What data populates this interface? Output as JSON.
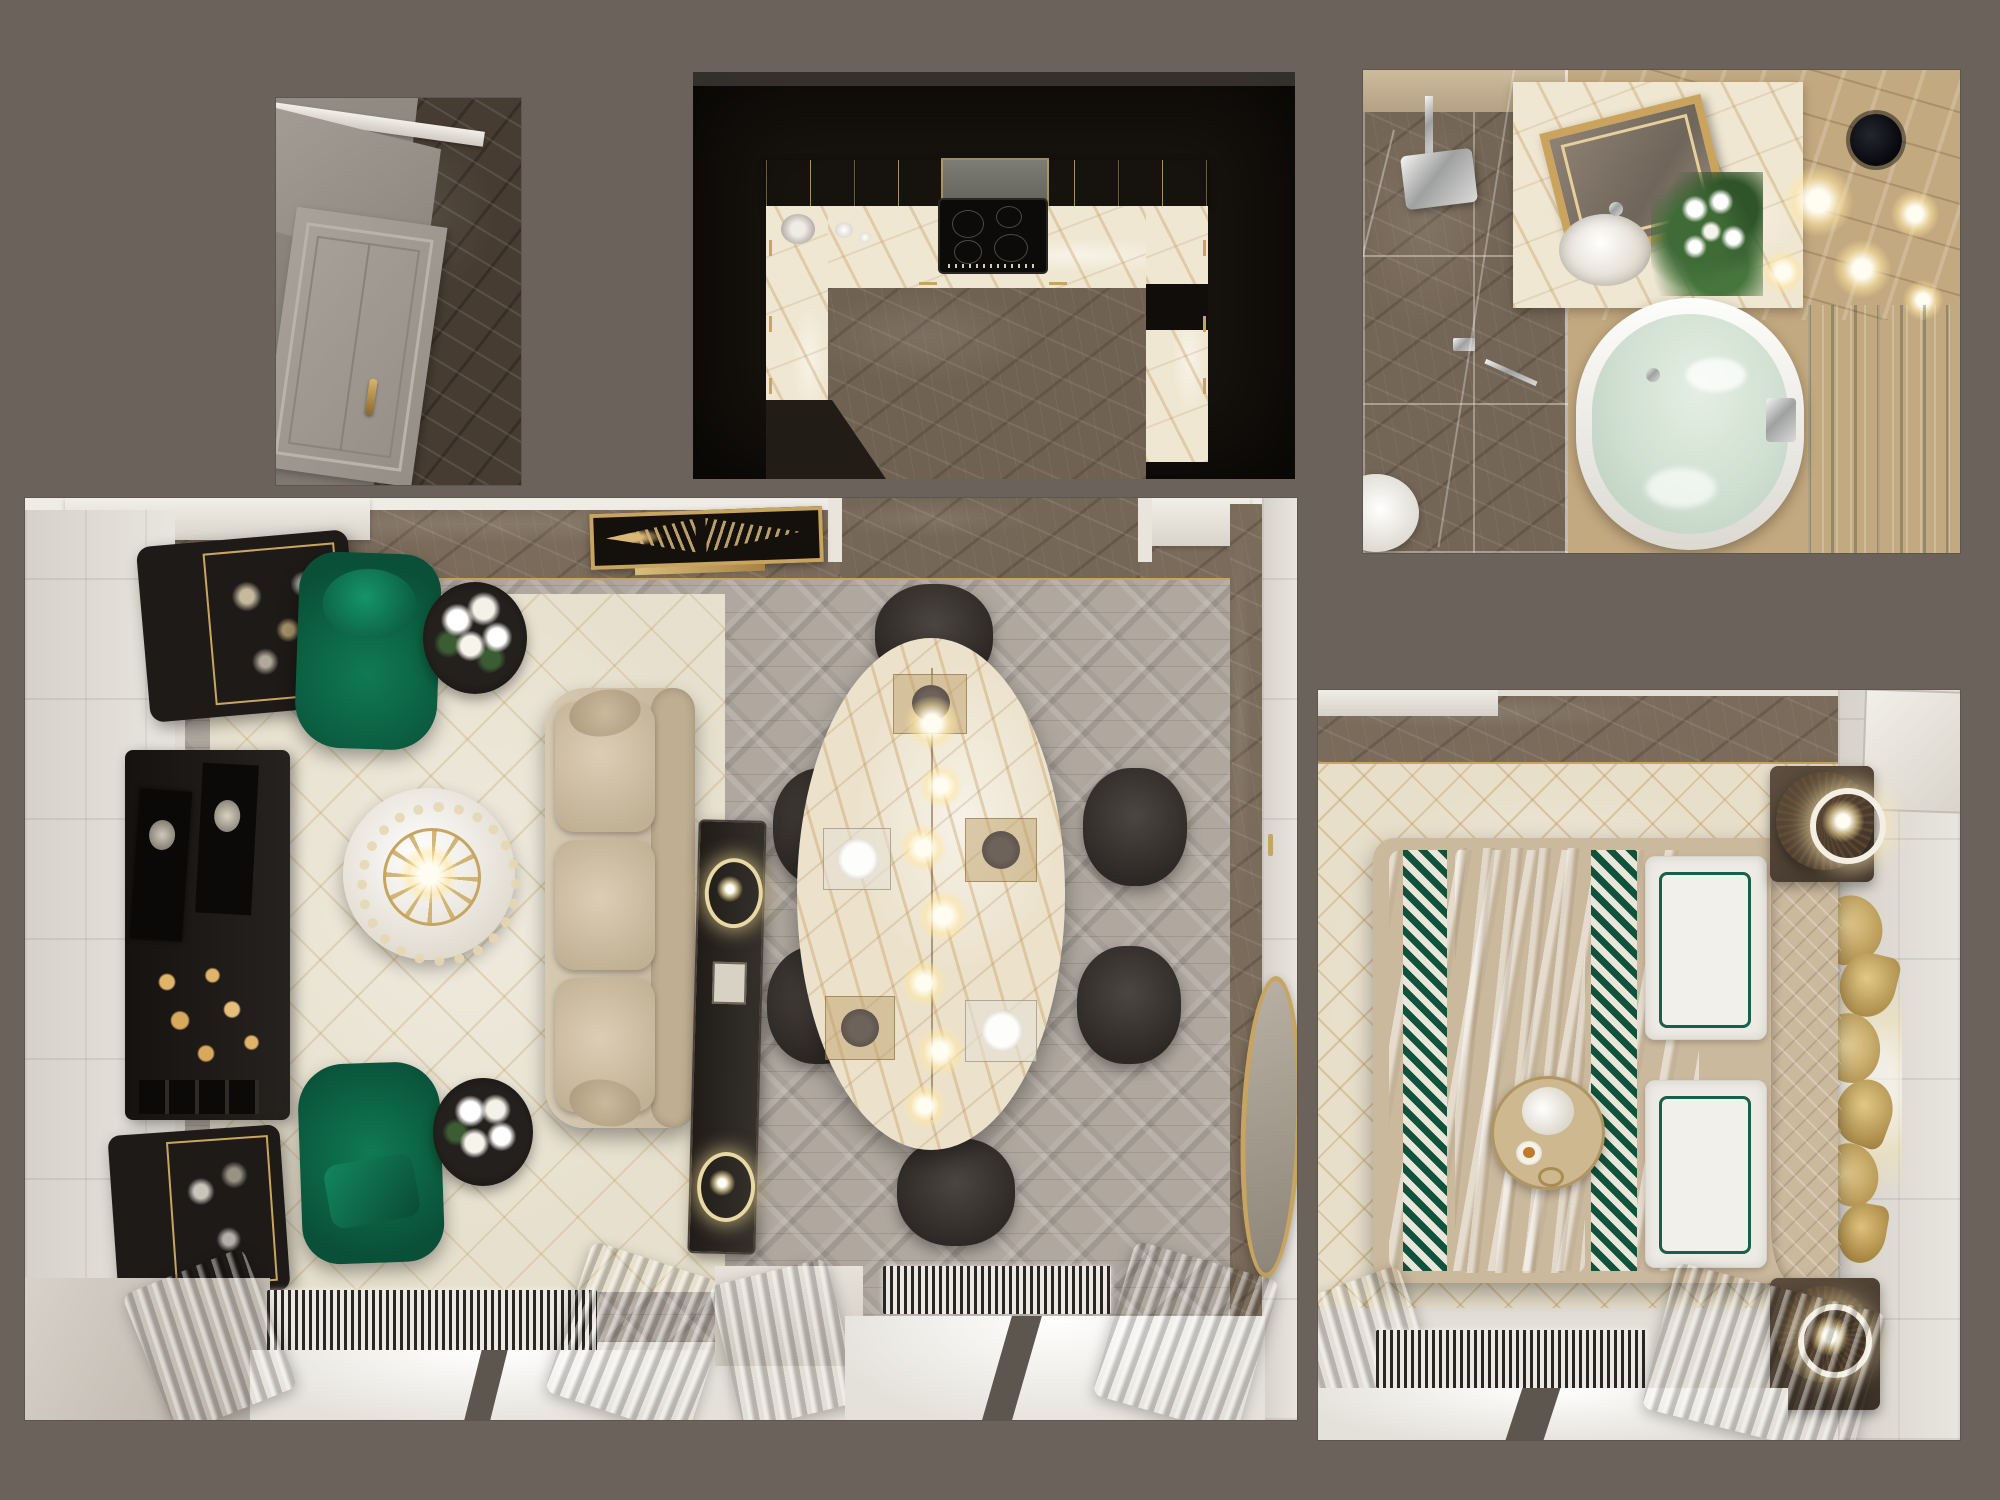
{
  "scene": {
    "description": "Collage of five top-down 3D interior renders of a neoclassical luxury apartment on a taupe background",
    "panels": [
      {
        "id": "hallway",
        "label": "Entry hallway - top-down view",
        "objects": [
          "white-entry-door",
          "brass-door-handle",
          "white-door-lintel",
          "dark-brown-marble-floor",
          "gray-wall"
        ]
      },
      {
        "id": "kitchen",
        "label": "Kitchen - top-down view",
        "objects": [
          "dark-surround",
          "upper-cabinets-with-gold-trim",
          "black-induction-cooktop",
          "u-shaped-cream-marble-countertop",
          "white-tableware",
          "brown-marble-floor",
          "gold-cabinet-handles"
        ]
      },
      {
        "id": "bathroom",
        "label": "Bathroom - top-down view",
        "objects": [
          "walk-in-shower",
          "chrome-rain-shower-head",
          "glass-partition",
          "brown-marble-shower-floor",
          "vanity-counter",
          "gold-framed-mirror",
          "oval-white-sink",
          "white-flower-arrangement",
          "ceiling-light-orbs",
          "black-ceiling-speaker",
          "white-toilet",
          "oval-bathtub-with-green-water",
          "chrome-bath-faucet",
          "green-onyx-wall"
        ]
      },
      {
        "id": "living-dining",
        "label": "Living and dining room - top-down view",
        "objects": [
          "ceiling-art-panel",
          "black-display-cabinet",
          "black-media-console",
          "black-glass-sideboard",
          "two-green-velvet-armchairs",
          "two-flower-side-tables",
          "round-coffee-table-with-chandelier",
          "beige-sofa",
          "slim-console-with-ring-lamps",
          "oval-marble-dining-table",
          "six-charcoal-dining-chairs",
          "pendant-bulb-lights",
          "herringbone-wood-floor",
          "gold-patterned-rug",
          "brown-marble-border",
          "white-paneled-walls",
          "gold-oval-wall-mirror",
          "two-window-bays",
          "striped-radiators",
          "taupe-curtains"
        ]
      },
      {
        "id": "bedroom",
        "label": "Bedroom - top-down view",
        "objects": [
          "double-bed",
          "white-duvet",
          "green-diamond-runners",
          "white-pillows-with-green-trim",
          "curved-beige-headboard",
          "breakfast-tray-with-flowers",
          "two-nightstands",
          "two-rattan-drum-lamps",
          "gold-leaf-wall-art",
          "white-paneled-wall",
          "lattice-pattern-rug",
          "brown-marble-border",
          "window-bay",
          "striped-radiator",
          "taupe-curtains"
        ]
      }
    ]
  },
  "palette": {
    "bg": "#6a625b",
    "wall_white": "#e3dfd7",
    "wall_gray": "#8e8880",
    "marble_brown": "#7a6b5a",
    "marble_dark": "#463c31",
    "marble_cream": "#f0e7d2",
    "wood_gray": "#b0a89f",
    "rug_cream": "#e7e0ce",
    "gold": "#c7a45f",
    "emerald": "#0d6b4a",
    "sofa_beige": "#cdbfa7",
    "charcoal": "#3a3532",
    "furniture_black": "#1d1a18",
    "curtain": "#a18f79",
    "water": "#cfdfd0",
    "onyx_tan": "#c3a97f",
    "onyx_green": "#7d8f84",
    "glow": "#fff3d6",
    "bed_beige": "#cbb99e",
    "radiator": "#2a2622",
    "kitchen_dark": "#17130e"
  }
}
